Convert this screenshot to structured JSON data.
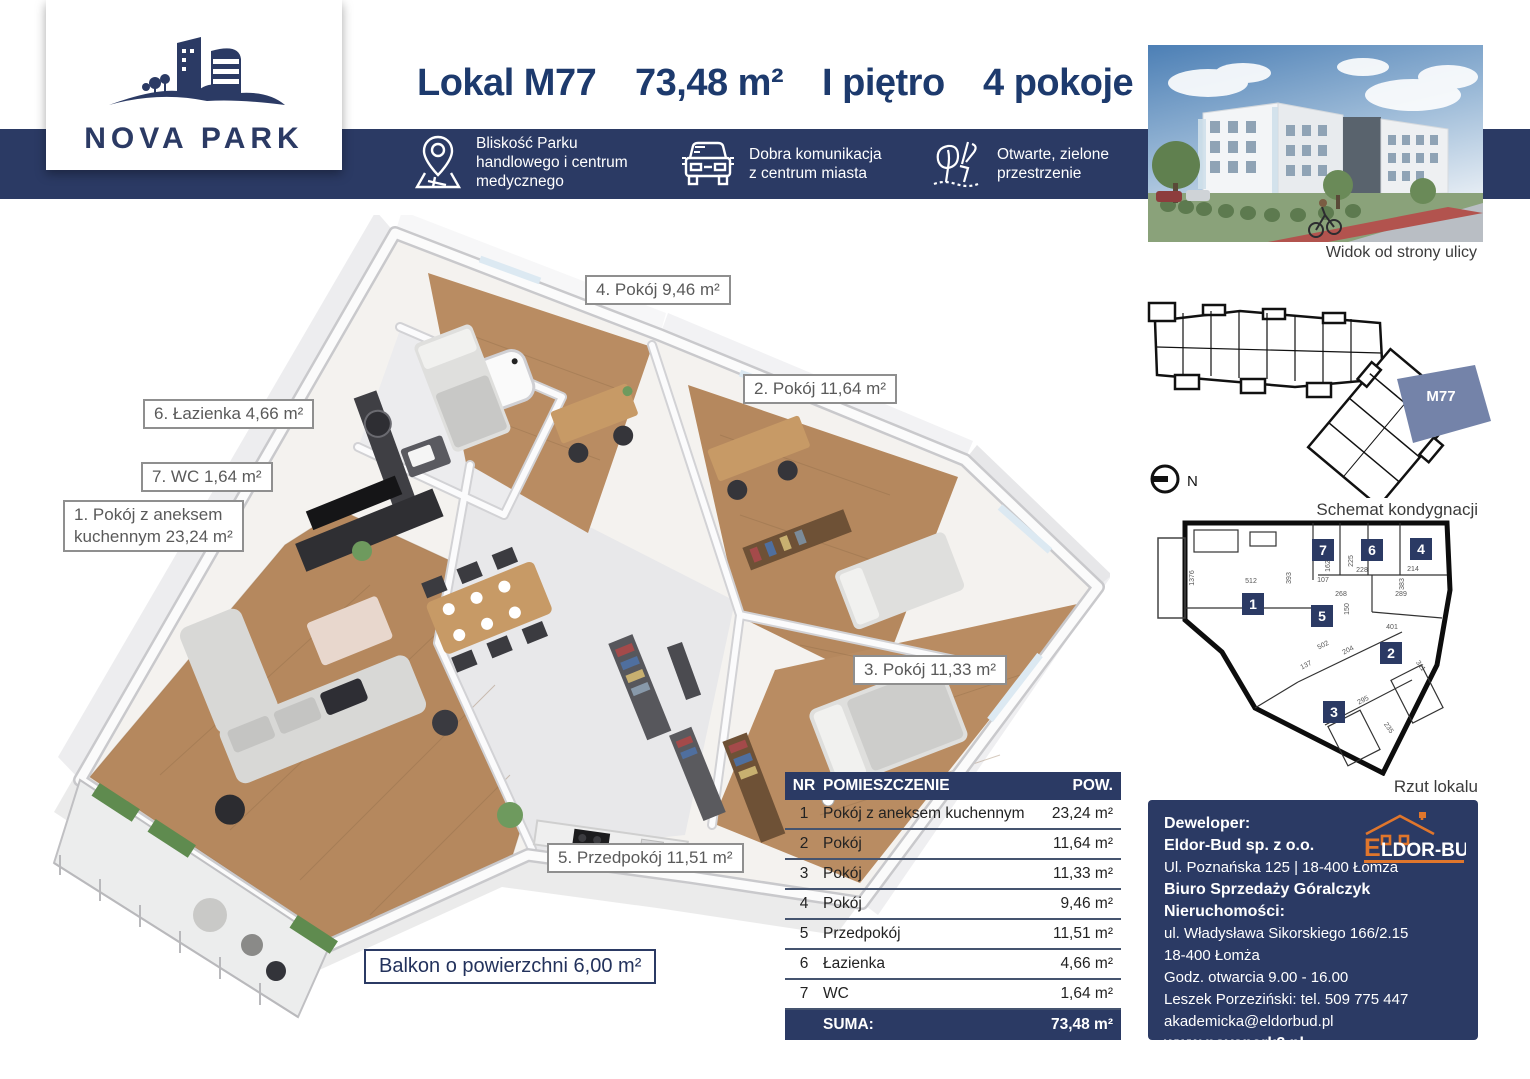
{
  "colors": {
    "navy": "#2b3a64",
    "title_navy": "#1d3a6d",
    "slate": "#7483a9",
    "orange": "#e0762c",
    "label_gray": "#5a5a5a",
    "wood": "#b5885e",
    "tile": "#e8e8ea"
  },
  "header": {
    "brand": "NOVA PARK",
    "title": {
      "unit": "Lokal M77",
      "area": "73,48 m²",
      "floor": "I piętro",
      "rooms": "4 pokoje"
    },
    "features": [
      {
        "icon": "map-pin-icon",
        "lines": [
          "Bliskość Parku",
          "handlowego i centrum",
          "medycznego"
        ]
      },
      {
        "icon": "car-icon",
        "lines": [
          "Dobra komunikacja",
          "z centrum miasta",
          ""
        ]
      },
      {
        "icon": "plant-icon",
        "lines": [
          "Otwarte, zielone",
          "przestrzenie",
          ""
        ]
      }
    ]
  },
  "plan3d": {
    "labels": [
      {
        "text": "4. Pokój 9,46 m²"
      },
      {
        "text": "2. Pokój 11,64 m²"
      },
      {
        "text": "6. Łazienka 4,66 m²"
      },
      {
        "text": "7. WC 1,64 m²"
      },
      {
        "line1": "1. Pokój z aneksem",
        "line2": "kuchennym 23,24 m²"
      },
      {
        "text": "3. Pokój 11,33 m²"
      },
      {
        "text": "5. Przedpokój 11,51 m²"
      }
    ],
    "balcony_label": "Balkon o powierzchni 6,00 m²"
  },
  "table": {
    "headers": {
      "nr": "NR",
      "room": "POMIESZCZENIE",
      "area": "POW."
    },
    "rows": [
      {
        "nr": "1",
        "name": "Pokój z aneksem kuchennym",
        "area": "23,24 m²"
      },
      {
        "nr": "2",
        "name": "Pokój",
        "area": "11,64 m²"
      },
      {
        "nr": "3",
        "name": "Pokój",
        "area": "11,33 m²"
      },
      {
        "nr": "4",
        "name": "Pokój",
        "area": "9,46 m²"
      },
      {
        "nr": "5",
        "name": "Przedpokój",
        "area": "11,51 m²"
      },
      {
        "nr": "6",
        "name": "Łazienka",
        "area": "4,66 m²"
      },
      {
        "nr": "7",
        "name": "WC",
        "area": "1,64 m²"
      }
    ],
    "sum_label": "SUMA:",
    "sum_value": "73,48 m²"
  },
  "sidebar": {
    "photo_caption": "Widok od strony ulicy",
    "schemat_caption": "Schemat kondygnacji",
    "rzut_caption": "Rzut lokalu",
    "compass_n": "N",
    "unit_highlight": "M77",
    "rzut_markers": [
      "1",
      "2",
      "3",
      "4",
      "5",
      "6",
      "7"
    ],
    "rzut_dimensions": [
      "1376",
      "512",
      "393",
      "107",
      "162",
      "225",
      "228",
      "214",
      "383",
      "268",
      "150",
      "289",
      "401",
      "311",
      "502",
      "137",
      "204",
      "295",
      "235"
    ]
  },
  "developer": {
    "logo_e": "E",
    "logo_rest": "LDOR-BUD",
    "lines": [
      "Deweloper:",
      "Eldor-Bud sp. z o.o.",
      "Ul. Poznańska 125 | 18-400 Łomża",
      "Biuro Sprzedaży Góralczyk Nieruchomości:",
      "ul. Władysława Sikorskiego 166/2.15",
      "18-400 Łomża",
      "Godz. otwarcia 9.00 - 16.00",
      "Leszek Porzeziński: tel. 509 775 447",
      "akademicka@eldorbud.pl",
      "www.novapark2.pl"
    ]
  }
}
